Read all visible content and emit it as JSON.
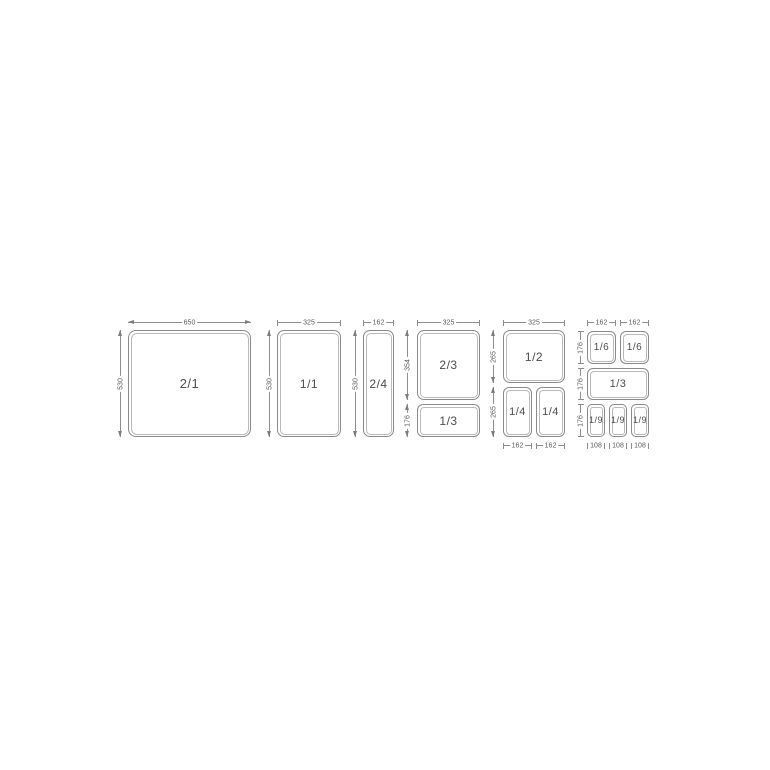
{
  "diagram": {
    "background": "#ffffff",
    "line_color": "#8d8d8d",
    "pan_border_color": "#8a8a8a",
    "pan_inner_border_color": "#b9b9b9",
    "label_color": "#4d4d4d",
    "dim_text_color": "#5a5a5a",
    "columns": [
      {
        "top_dims": [
          "650"
        ],
        "left_dims": [
          "530"
        ],
        "bottom_dims": [],
        "pans": [
          {
            "label": "2/1"
          }
        ]
      },
      {
        "top_dims": [
          "325"
        ],
        "left_dims": [
          "530"
        ],
        "bottom_dims": [],
        "pans": [
          {
            "label": "1/1"
          }
        ]
      },
      {
        "top_dims": [
          "162"
        ],
        "left_dims": [
          "530"
        ],
        "bottom_dims": [],
        "pans": [
          {
            "label": "2/4"
          }
        ]
      },
      {
        "top_dims": [
          "325"
        ],
        "left_dims": [
          "354",
          "176"
        ],
        "bottom_dims": [],
        "pans": [
          {
            "label": "2/3"
          },
          {
            "label": "1/3"
          }
        ]
      },
      {
        "top_dims": [
          "325"
        ],
        "left_dims": [
          "265",
          "265"
        ],
        "bottom_dims": [
          "162",
          "162"
        ],
        "pans": [
          {
            "label": "1/2"
          },
          {
            "label": "1/4"
          },
          {
            "label": "1/4"
          }
        ]
      },
      {
        "top_dims": [
          "162",
          "162"
        ],
        "left_dims": [
          "176",
          "176",
          "176"
        ],
        "bottom_dims": [
          "108",
          "108",
          "108"
        ],
        "pans": [
          {
            "label": "1/6"
          },
          {
            "label": "1/6"
          },
          {
            "label": "1/3"
          },
          {
            "label": "1/9"
          },
          {
            "label": "1/9"
          },
          {
            "label": "1/9"
          }
        ]
      }
    ]
  }
}
